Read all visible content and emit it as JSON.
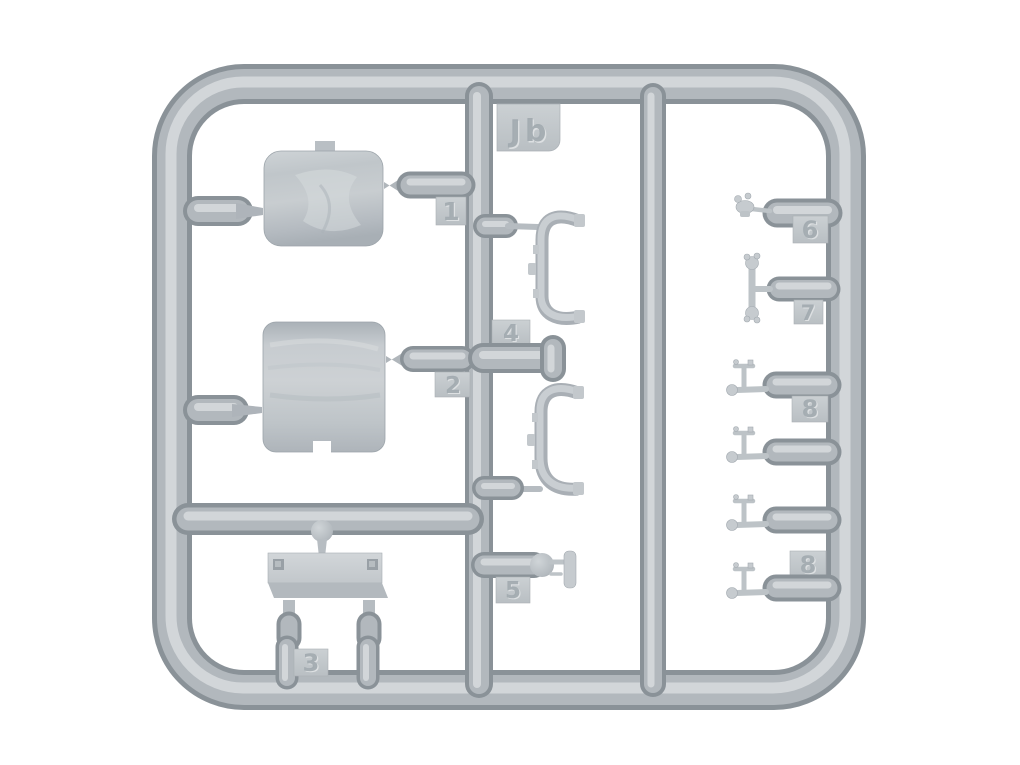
{
  "sprue": {
    "id_label": "Jb",
    "tags": [
      {
        "label": "1"
      },
      {
        "label": "2"
      },
      {
        "label": "3"
      },
      {
        "label": "4"
      },
      {
        "label": "5"
      },
      {
        "label": "6"
      },
      {
        "label": "7"
      },
      {
        "label": "8"
      },
      {
        "label": "8"
      }
    ],
    "colors": {
      "background": "#ffffff",
      "plastic_dark": "#8a9298",
      "plastic_base": "#b2b8bd",
      "plastic_highlight": "#d2d6d9",
      "part_light": "#c8cdd1"
    }
  }
}
